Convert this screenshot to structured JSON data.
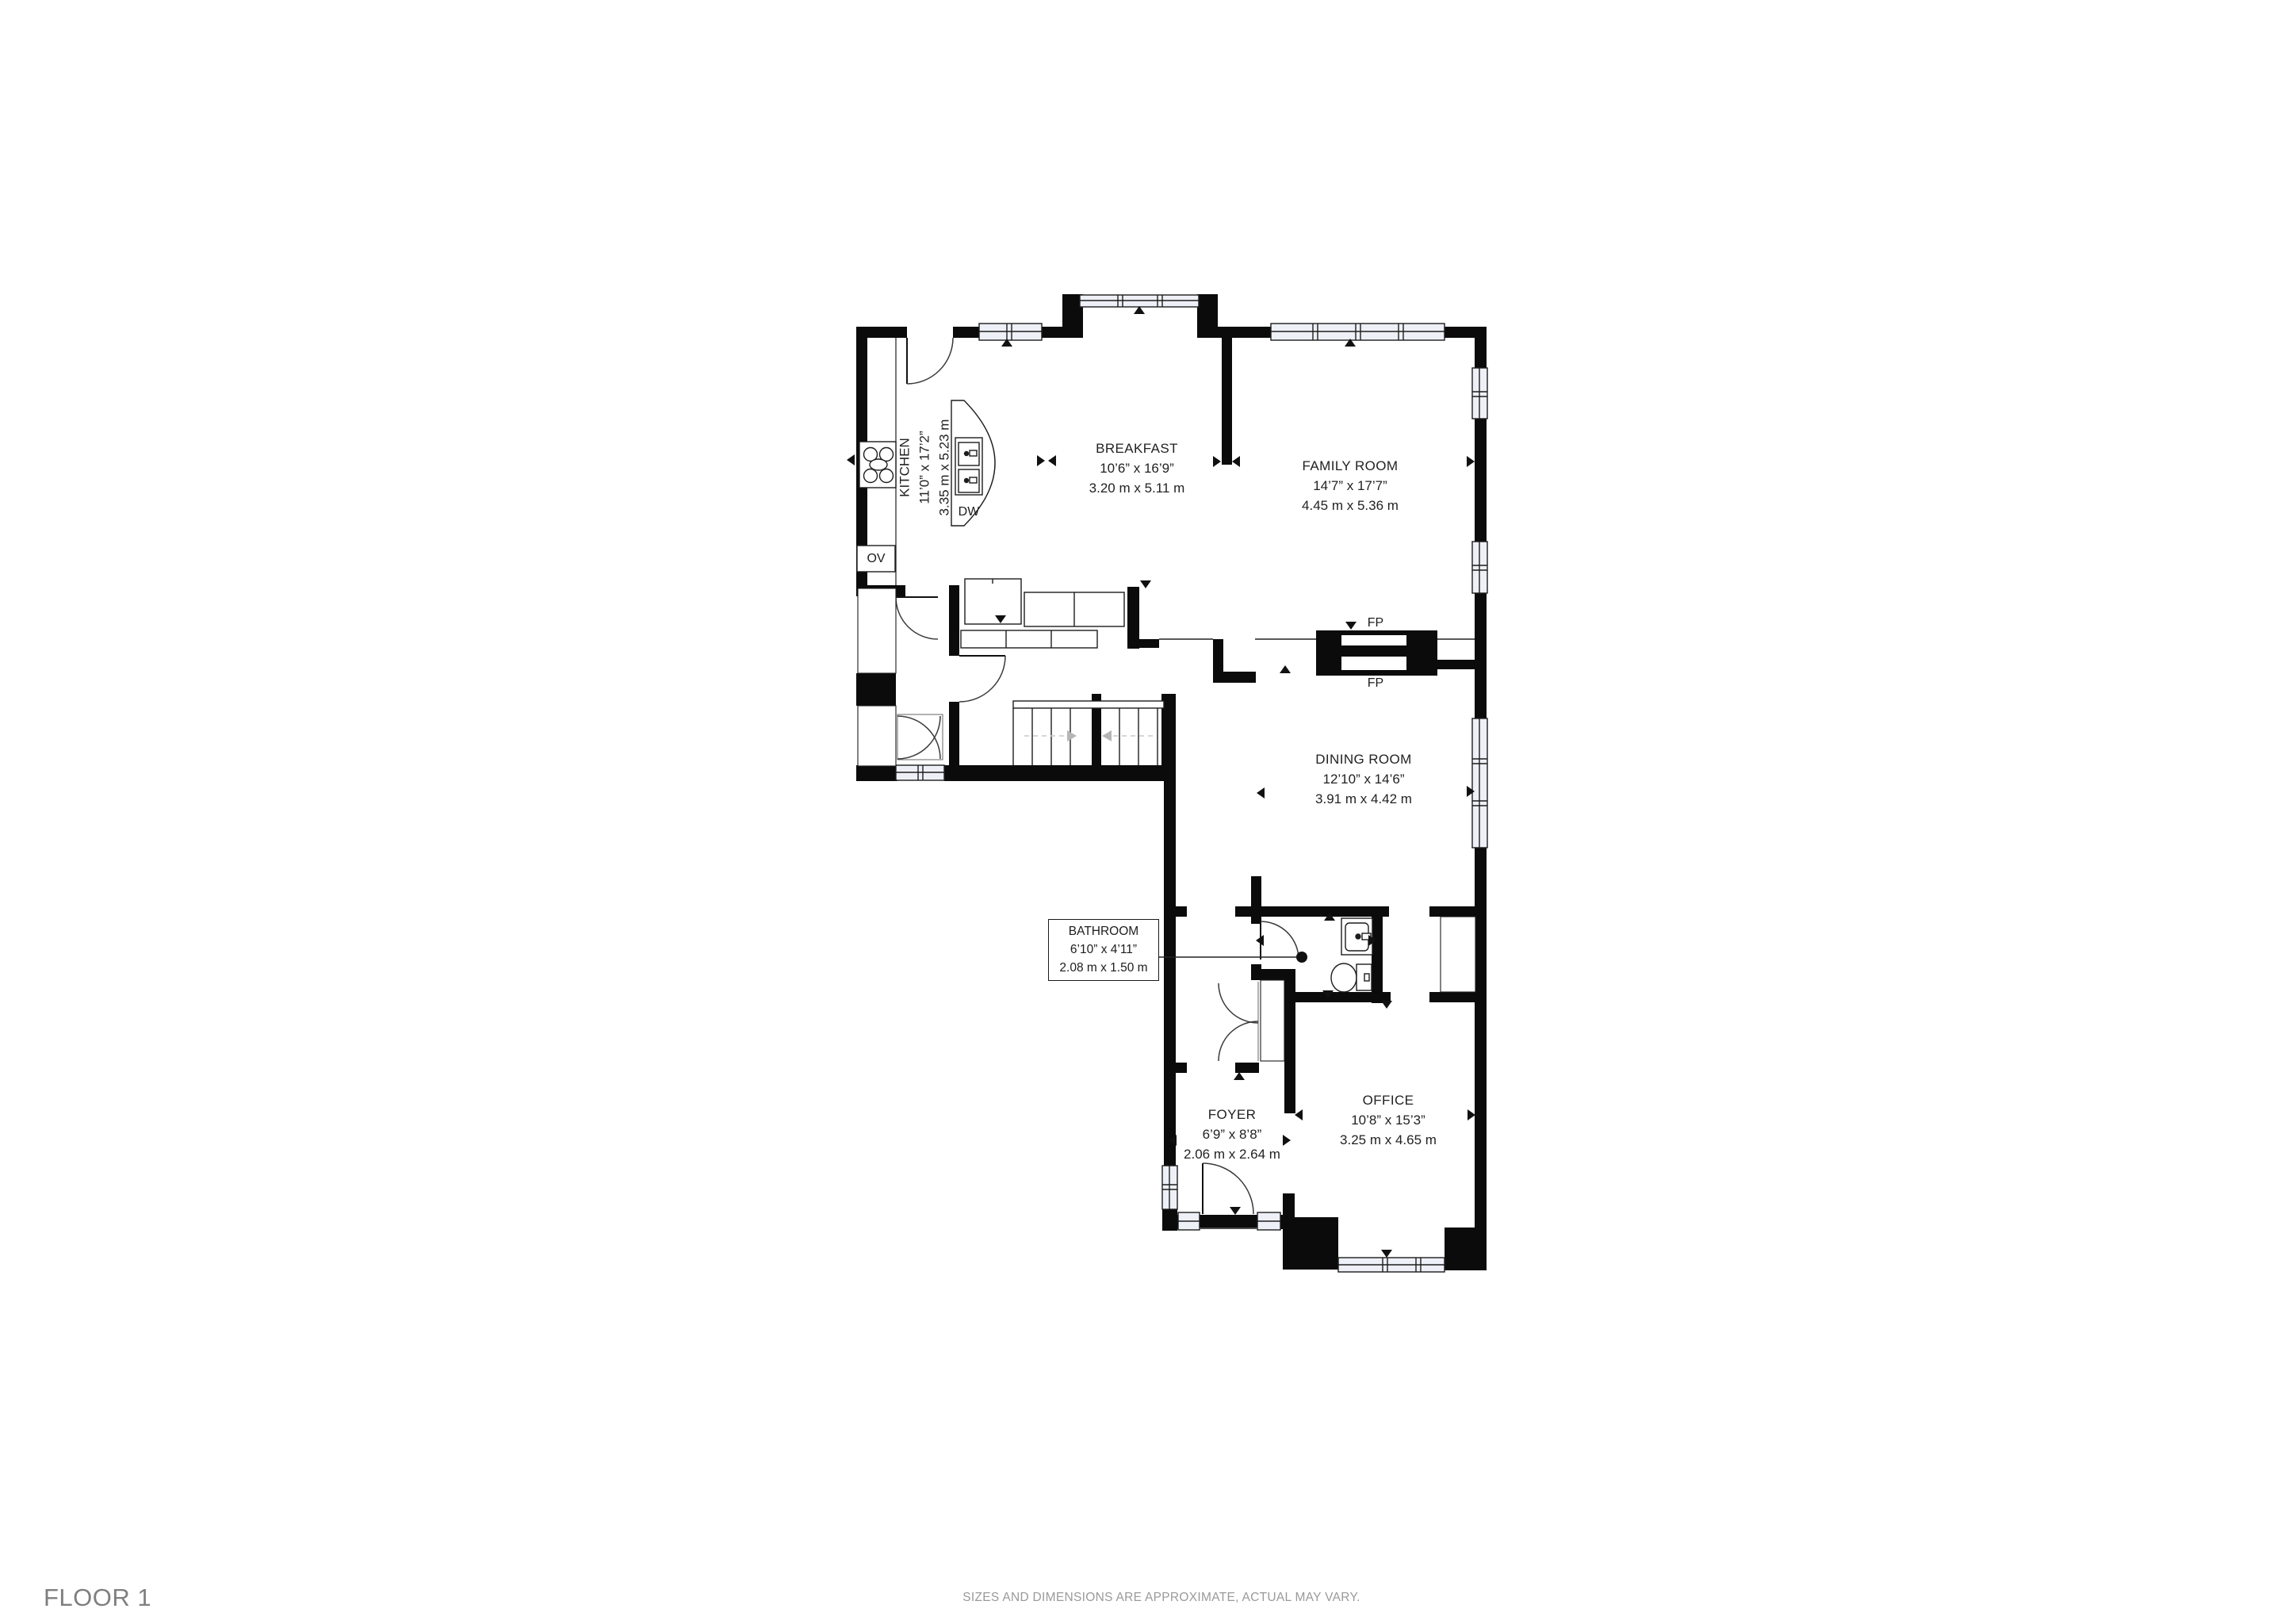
{
  "footer": {
    "floor_label": "FLOOR 1",
    "disclaimer": "SIZES AND DIMENSIONS ARE APPROXIMATE, ACTUAL MAY VARY."
  },
  "rooms": {
    "kitchen": {
      "name": "KITCHEN",
      "imperial": "11’0” x 17’2”",
      "metric": "3.35 m x 5.23 m"
    },
    "breakfast": {
      "name": "BREAKFAST",
      "imperial": "10’6” x 16’9”",
      "metric": "3.20 m x 5.11 m"
    },
    "family": {
      "name": "FAMILY ROOM",
      "imperial": "14’7” x 17’7”",
      "metric": "4.45 m x 5.36 m"
    },
    "dining": {
      "name": "DINING ROOM",
      "imperial": "12’10” x 14’6”",
      "metric": "3.91 m x 4.42 m"
    },
    "bathroom": {
      "name": "BATHROOM",
      "imperial": "6’10” x 4’11”",
      "metric": "2.08 m x 1.50 m"
    },
    "foyer": {
      "name": "FOYER",
      "imperial": "6’9” x 8’8”",
      "metric": "2.06 m x 2.64 m"
    },
    "office": {
      "name": "OFFICE",
      "imperial": "10’8” x 15’3”",
      "metric": "3.25 m x 4.65 m"
    }
  },
  "labels": {
    "dishwasher": "DW",
    "oven": "OV",
    "fireplace_upper": "FP",
    "fireplace_lower": "FP"
  },
  "colors": {
    "wall": "#0b0b0b",
    "window_fill": "#eef0f7",
    "text": "#2a2a2a",
    "muted_text": "#8f8f8f",
    "stair_arrow": "#b5b5b5"
  }
}
